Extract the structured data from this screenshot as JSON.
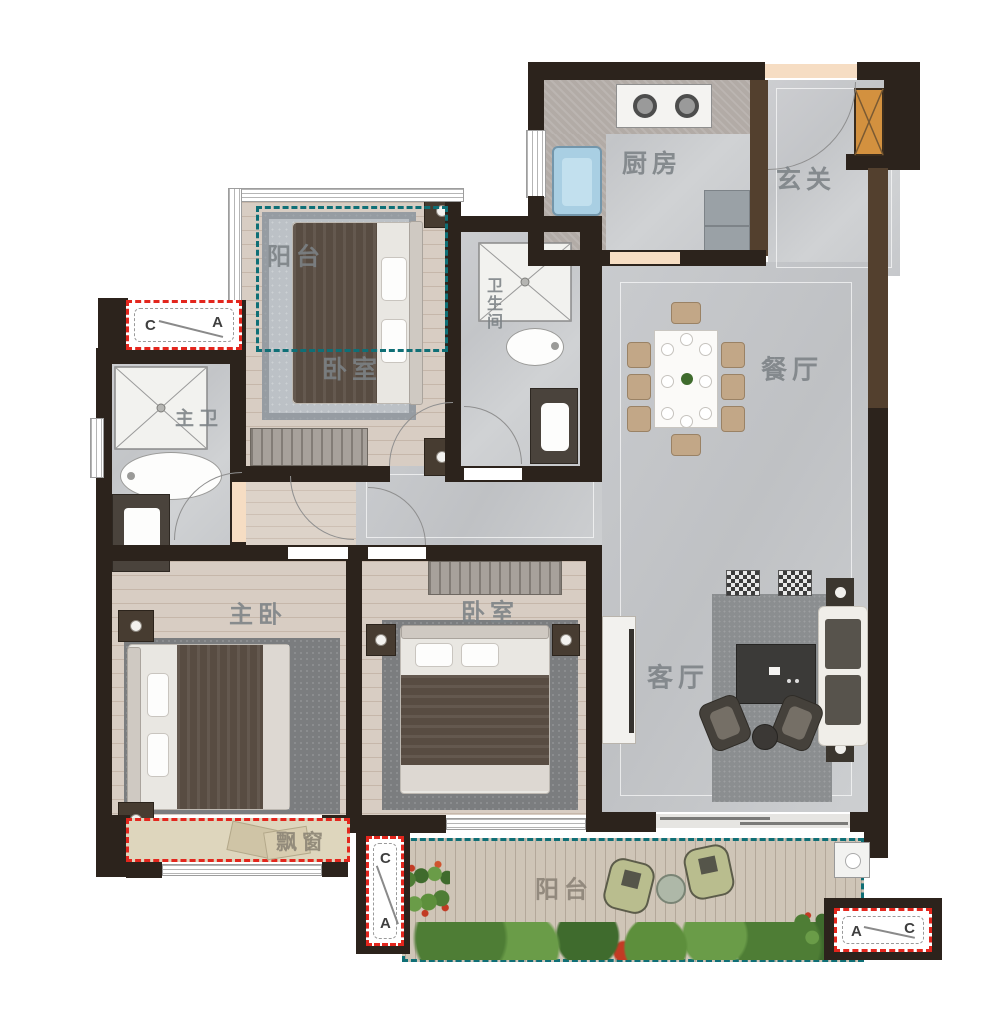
{
  "floorplan": {
    "rooms": {
      "kitchen": "厨房",
      "foyer": "玄关",
      "dining": "餐厅",
      "living": "客厅",
      "bedroom_upper": "卧室",
      "balcony_upper": "阳台",
      "bathroom": "卫生间",
      "master_bath": "主卫",
      "master_bedroom": "主卧",
      "bedroom_second": "卧室",
      "bay_window": "飘窗",
      "balcony_lower": "阳台"
    },
    "section_markers": {
      "upper_left": {
        "a": "C",
        "b": "A"
      },
      "bottom_center": {
        "a": "C",
        "b": "A"
      },
      "bottom_right": {
        "a": "A",
        "b": "C"
      }
    },
    "colors": {
      "wall": "#2c231c",
      "wall_brown": "#53402e",
      "tile_floor": "#c7c9cc",
      "wood_floor": "#d8cdc3",
      "balcony_teal": "#0f6f76",
      "marker_red": "#e3261d",
      "shaft_orange": "#d3913f",
      "sink_blue": "#a9cfe3",
      "bay_fill": "#ded6bd"
    }
  }
}
